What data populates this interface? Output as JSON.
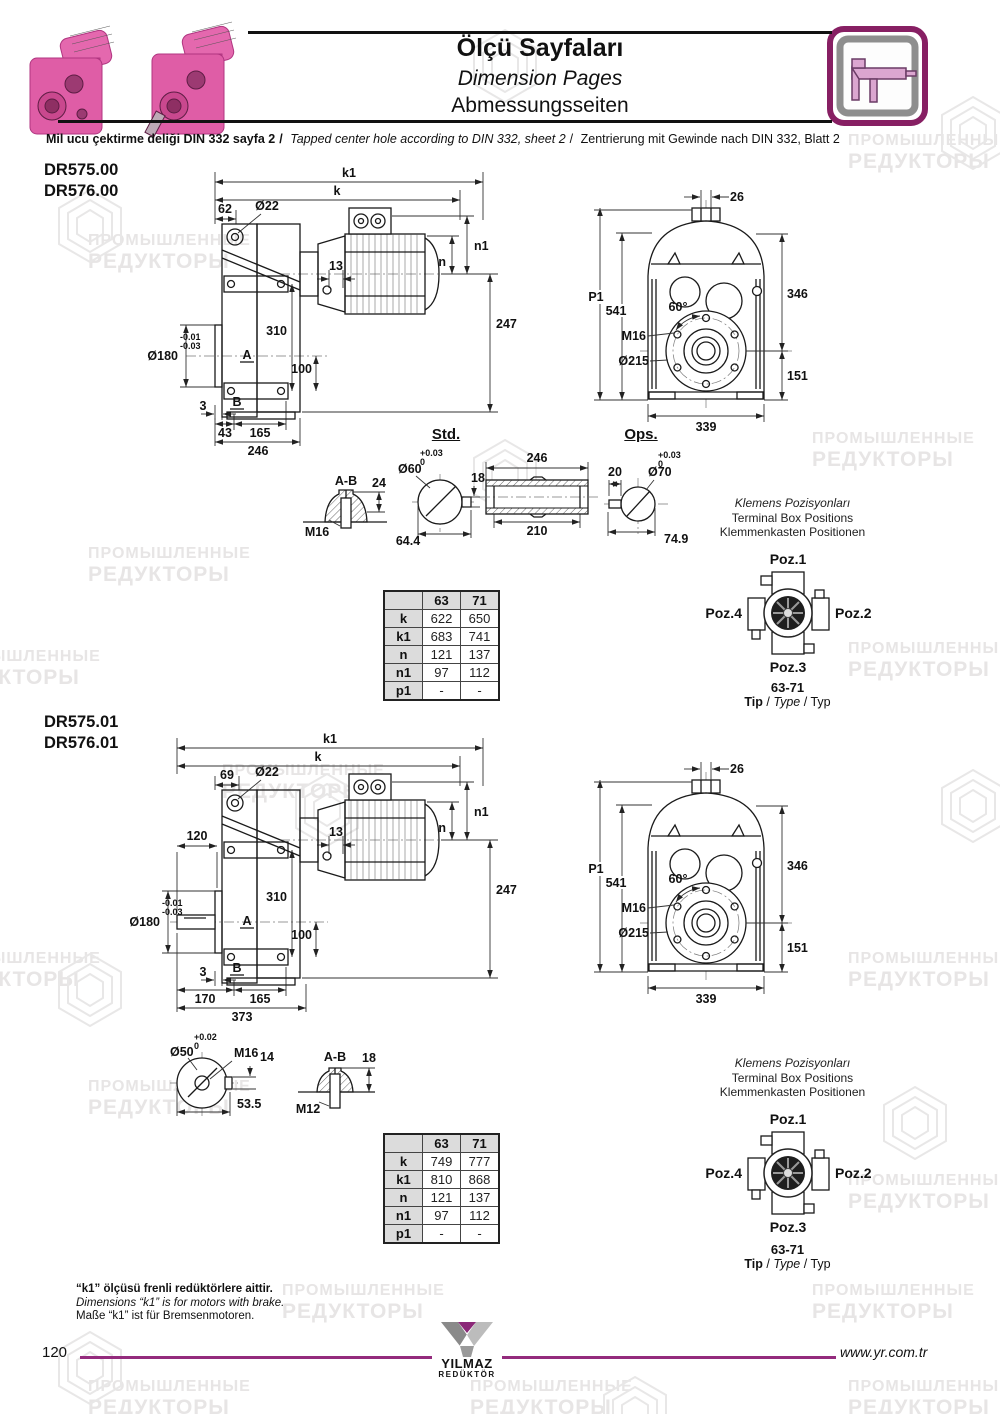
{
  "watermark": {
    "line1": "ПРОМЫШЛЕННЫЕ",
    "line2": "РЕДУКТОРЫ"
  },
  "header": {
    "title_tr": "Ölçü Sayfaları",
    "title_en": "Dimension Pages",
    "title_de": "Abmessungsseiten",
    "note_tr": "Mil ucu çektirme deliği DIN 332 sayfa 2",
    "note_sep": "/",
    "note_en": "Tapped center hole according to DIN 332, sheet 2",
    "note_de": "Zentrierung mit Gewinde nach DIN 332, Blatt 2"
  },
  "sections": [
    {
      "models": [
        "DR575.00",
        "DR576.00"
      ],
      "side": {
        "k1": "k1",
        "k": "k",
        "offset": "62",
        "hole": "Ø22",
        "n1": "n1",
        "n": "n",
        "d13": "13",
        "d247": "247",
        "d310": "310",
        "d100": "100",
        "bore": "Ø180",
        "tol_hi": "-0.01",
        "tol_lo": "-0.03",
        "mark_a": "A",
        "mark_b": "B",
        "d3": "3",
        "b1": "43",
        "b2": "165",
        "b3": "246"
      },
      "front": {
        "d26": "26",
        "p1": "P1",
        "d541": "541",
        "d346": "346",
        "d151": "151",
        "d339": "339",
        "angle": "60°",
        "m16": "M16",
        "flange": "Ø215"
      },
      "std_heading": "Std.",
      "ops_heading": "Ops.",
      "ab": {
        "title": "A-B",
        "h": "24",
        "thread": "M16"
      },
      "std": {
        "tol_hi": "+0.03",
        "tol_lo": "0",
        "dia": "Ø60",
        "key": "18",
        "across": "64.4"
      },
      "sleeve": {
        "len": "246",
        "bore_len": "210"
      },
      "ops": {
        "key": "20",
        "tol_hi": "+0.03",
        "tol_lo": "0",
        "dia": "Ø70",
        "across": "74.9"
      },
      "klemens": {
        "l1": "Klemens Pozisyonları",
        "l2": "Terminal Box Positions",
        "l3": "Klemmenkasten Positionen"
      },
      "table": {
        "col1": "63",
        "col2": "71",
        "rows": [
          [
            "k",
            "622",
            "650"
          ],
          [
            "k1",
            "683",
            "741"
          ],
          [
            "n",
            "121",
            "137"
          ],
          [
            "n1",
            "97",
            "112"
          ],
          [
            "p1",
            "-",
            "-"
          ]
        ]
      },
      "poz": {
        "p1": "Poz.1",
        "p2": "Poz.2",
        "p3": "Poz.3",
        "p4": "Poz.4",
        "range": "63-71",
        "tip": "Tip",
        "type": "Type",
        "typ": "Typ",
        "sep": "/"
      }
    },
    {
      "models": [
        "DR575.01",
        "DR576.01"
      ],
      "side": {
        "k1": "k1",
        "k": "k",
        "offset": "69",
        "hole": "Ø22",
        "n1": "n1",
        "n": "n",
        "d13": "13",
        "d247": "247",
        "d310": "310",
        "d100": "100",
        "d120": "120",
        "bore": "Ø180",
        "tol_hi": "-0.01",
        "tol_lo": "-0.03",
        "mark_a": "A",
        "mark_b": "B",
        "d3": "3",
        "b1": "170",
        "b2": "165",
        "b3": "373"
      },
      "front": {
        "d26": "26",
        "p1": "P1",
        "d541": "541",
        "d346": "346",
        "d151": "151",
        "d339": "339",
        "angle": "60°",
        "m16": "M16",
        "flange": "Ø215"
      },
      "shaft": {
        "tol_hi": "+0.02",
        "tol_lo": "0",
        "dia": "Ø50",
        "thread": "M16",
        "key": "14",
        "across": "53.5"
      },
      "ab": {
        "title": "A-B",
        "h": "18",
        "thread": "M12"
      },
      "klemens": {
        "l1": "Klemens Pozisyonları",
        "l2": "Terminal Box Positions",
        "l3": "Klemmenkasten Positionen"
      },
      "table": {
        "col1": "63",
        "col2": "71",
        "rows": [
          [
            "k",
            "749",
            "777"
          ],
          [
            "k1",
            "810",
            "868"
          ],
          [
            "n",
            "121",
            "137"
          ],
          [
            "n1",
            "97",
            "112"
          ],
          [
            "p1",
            "-",
            "-"
          ]
        ]
      },
      "poz": {
        "p1": "Poz.1",
        "p2": "Poz.2",
        "p3": "Poz.3",
        "p4": "Poz.4",
        "range": "63-71",
        "tip": "Tip",
        "type": "Type",
        "typ": "Typ",
        "sep": "/"
      }
    }
  ],
  "footnote": {
    "tr": "“k1” ölçüsü frenli redüktörlere aittir.",
    "en": "Dimensions “k1” is for motors with brake.",
    "de": "Maße “k1” ist für Bremsenmotoren."
  },
  "footer": {
    "page": "120",
    "logo1": "YILMAZ",
    "logo2": "REDÜKTÖR",
    "url": "www.yr.com.tr"
  },
  "colors": {
    "accent": "#942b7d",
    "pink": "#df5da6",
    "table_header_bg": "#dcdcdc",
    "line": "#1a1a1a"
  }
}
